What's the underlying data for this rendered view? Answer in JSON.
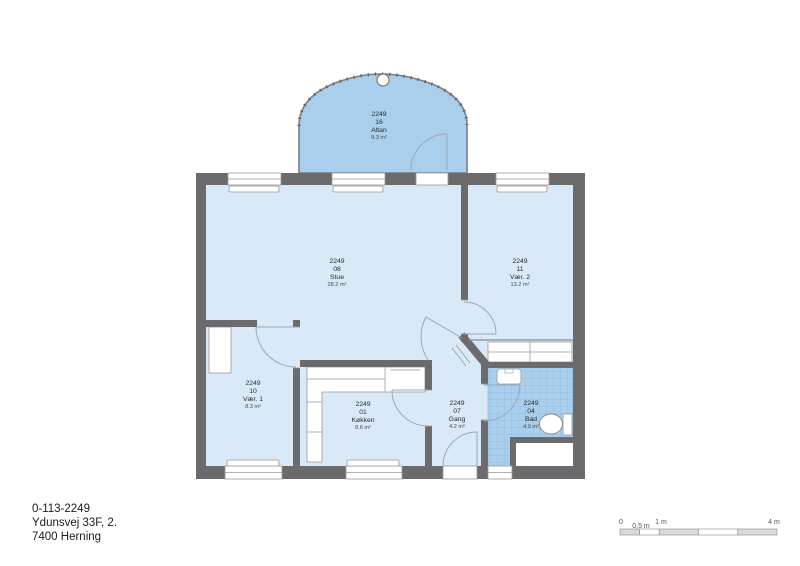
{
  "plan": {
    "building_id": "2249",
    "rooms": [
      {
        "key": "altan",
        "building": "2249",
        "number": "16",
        "name": "Altan",
        "area": "9.3 m²"
      },
      {
        "key": "stue",
        "building": "2249",
        "number": "08",
        "name": "Stue",
        "area": "28.2 m²"
      },
      {
        "key": "vaer2",
        "building": "2249",
        "number": "11",
        "name": "Vær. 2",
        "area": "13.2 m²"
      },
      {
        "key": "vaer1",
        "building": "2249",
        "number": "10",
        "name": "Vær. 1",
        "area": "8.3 m²"
      },
      {
        "key": "koekken",
        "building": "2249",
        "number": "01",
        "name": "Køkken",
        "area": "8.6 m²"
      },
      {
        "key": "gang",
        "building": "2249",
        "number": "07",
        "name": "Gang",
        "area": "4.2 m²"
      },
      {
        "key": "bad",
        "building": "2249",
        "number": "04",
        "name": "Bad",
        "area": "4.9 m²"
      }
    ],
    "colors": {
      "floor_fill": "#d9e9f8",
      "wet_fill": "#a9cfec",
      "tile_line": "#8cb9e0",
      "wall": "#6b6b6d"
    }
  },
  "footer": {
    "id_line": "0-113-2249",
    "address_line": "Ydunsvej 33F, 2.",
    "city_line": "7400 Herning"
  },
  "scale_bar": {
    "labels": [
      "0",
      "0,5 m",
      "1 m",
      "4 m"
    ]
  }
}
